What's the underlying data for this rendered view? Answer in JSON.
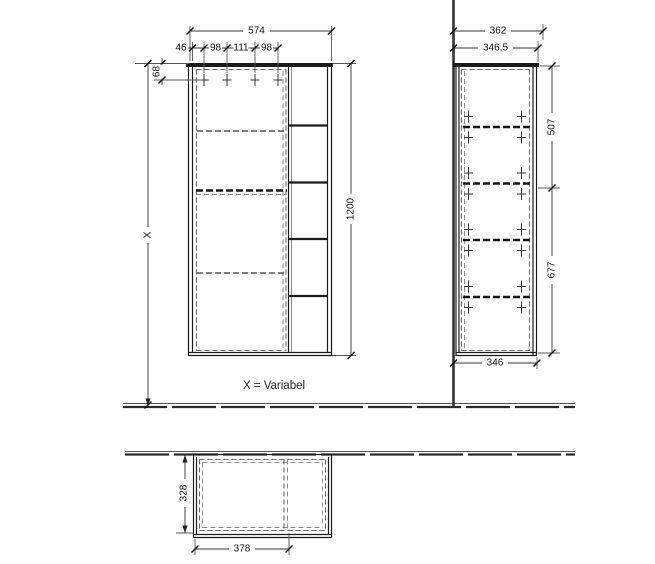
{
  "note": {
    "text": "X = Variabel"
  },
  "front": {
    "width": "574",
    "offsets": [
      "46",
      "98",
      "111",
      "98"
    ],
    "top_hole_offset": "68",
    "height": "1200",
    "variable": "X"
  },
  "side": {
    "depth_overall": "362",
    "depth_body": "346,5",
    "upper_section": "507",
    "lower_section": "677",
    "bottom_depth": "346"
  },
  "plan": {
    "depth": "328",
    "width": "378"
  },
  "colors": {
    "line": "#1a1a1a",
    "dashed": "#666666",
    "background": "#ffffff"
  }
}
